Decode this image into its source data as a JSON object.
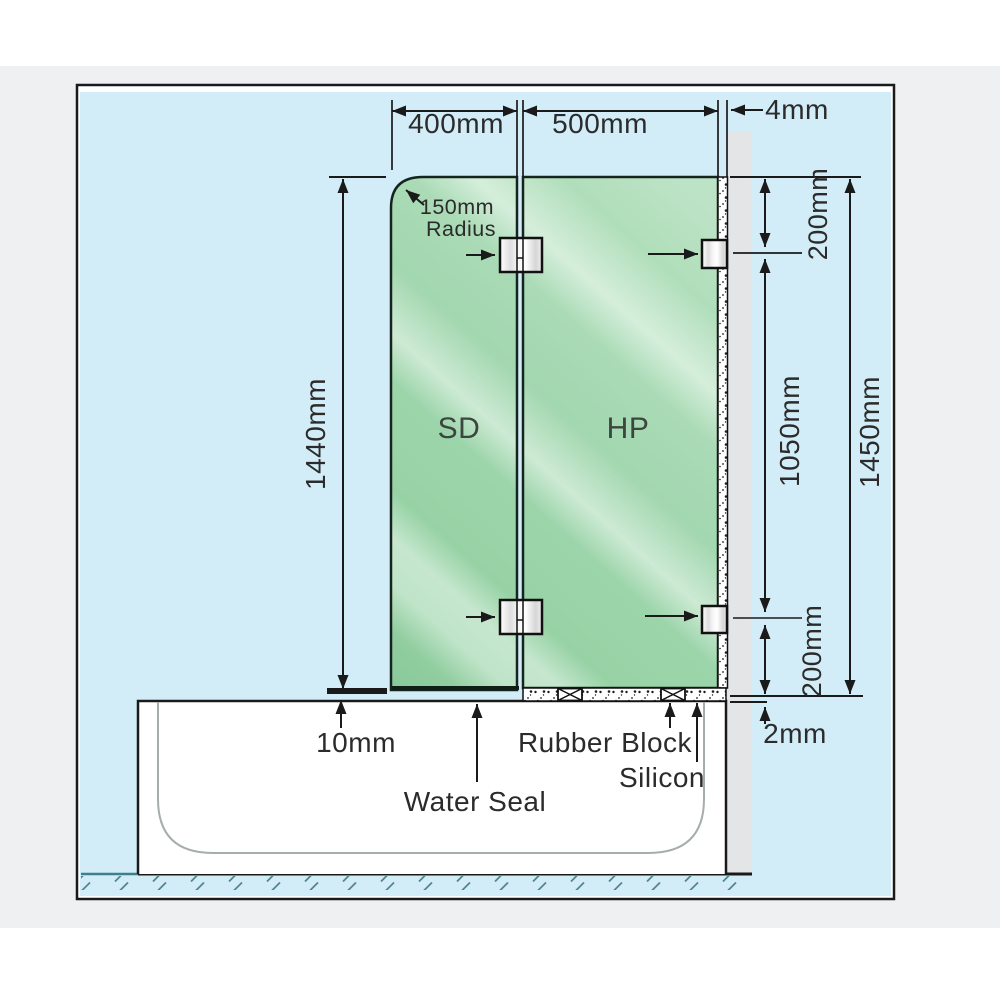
{
  "diagram": {
    "type": "shower-screen-installation-diagram",
    "panels": [
      {
        "code": "SD",
        "width": "400mm",
        "height": "1440mm",
        "corner_radius": "150mm"
      },
      {
        "code": "HP",
        "width": "500mm",
        "height": "1450mm"
      }
    ],
    "labels": {
      "width_sd": "400mm",
      "width_hp": "500mm",
      "wall_gap": "4mm",
      "height_sd": "1440mm",
      "bracket_top_offset": "200mm",
      "bracket_spacing": "1050mm",
      "bracket_bottom_offset": "200mm",
      "height_hp": "1450mm",
      "bottom_gap_sd": "10mm",
      "bottom_gap_hp": "2mm",
      "radius_value": "150mm",
      "radius_word": "Radius",
      "panel_sd": "SD",
      "panel_hp": "HP",
      "water_seal": "Water Seal",
      "rubber_block": "Rubber Block",
      "silicon": "Silicon"
    },
    "colors": {
      "page_margin": "#eef0f2",
      "wall_blue": "#d2edf7",
      "glass_green": "#9bd4a9",
      "glass_highlight": "#cdebd5",
      "wall_strip": "#e4e5e6",
      "tub": "#ffffff",
      "outline": "#1a1a1a",
      "floor_hatch": "#54858e"
    }
  }
}
